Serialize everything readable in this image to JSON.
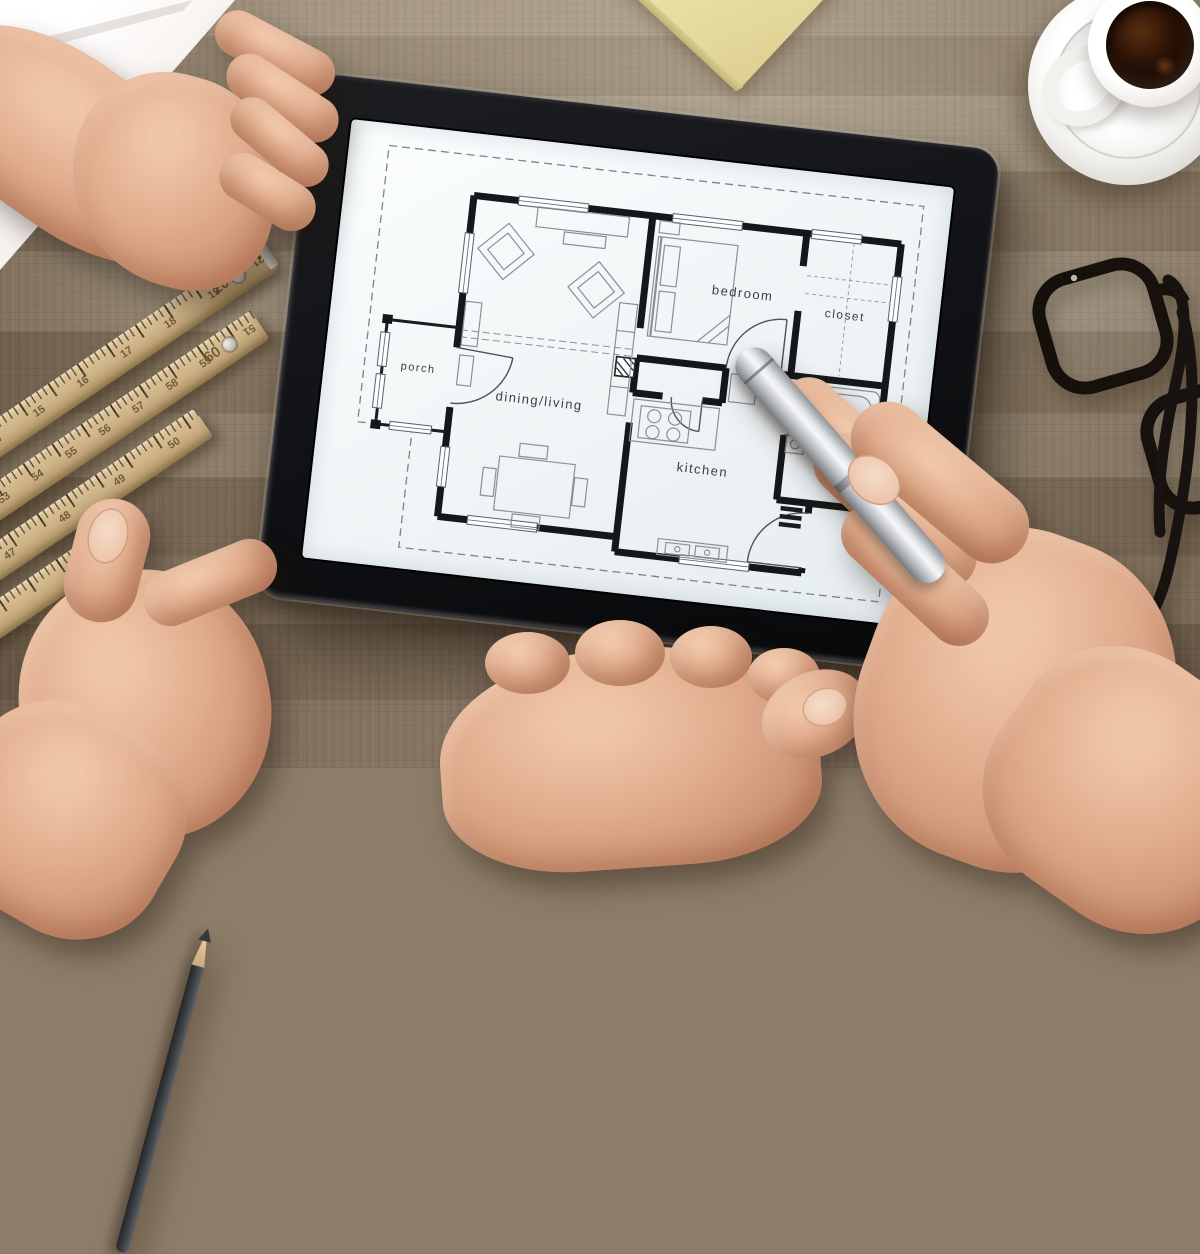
{
  "tablet": {
    "floor_plan": {
      "rooms": {
        "porch": {
          "label": "porch"
        },
        "dining_living": {
          "label": "dining/living"
        },
        "bedroom": {
          "label": "bedroom"
        },
        "closet": {
          "label": "closet"
        },
        "bathroom": {
          "label": "bathroom"
        },
        "kitchen": {
          "label": "kitchen"
        }
      }
    }
  },
  "rulers": {
    "strip1": {
      "numbers": [
        "14",
        "15",
        "16",
        "17",
        "18",
        "19"
      ],
      "start_label": "10",
      "hinge_label": "20",
      "end_label": "21"
    },
    "strip2": {
      "numbers": [
        "52",
        "53",
        "54",
        "55",
        "56",
        "57",
        "58",
        "59"
      ],
      "start_label": "50",
      "hinge_label": "60",
      "end_label": "51"
    },
    "strip3": {
      "numbers": [
        "46",
        "47",
        "48",
        "49",
        "50"
      ]
    }
  },
  "colors": {
    "desk_wood": "#93846e",
    "tablet_body": "#121316",
    "screen": "#eef3f5",
    "plan_line": "#15181a",
    "skin": "#e0ac8d",
    "stylus_silver": "#c8cbcf",
    "sticky_note": "#e9dfa6",
    "ruler_wood": "#cbb083",
    "coffee": "#1d0c03",
    "paper": "#f4efec"
  }
}
